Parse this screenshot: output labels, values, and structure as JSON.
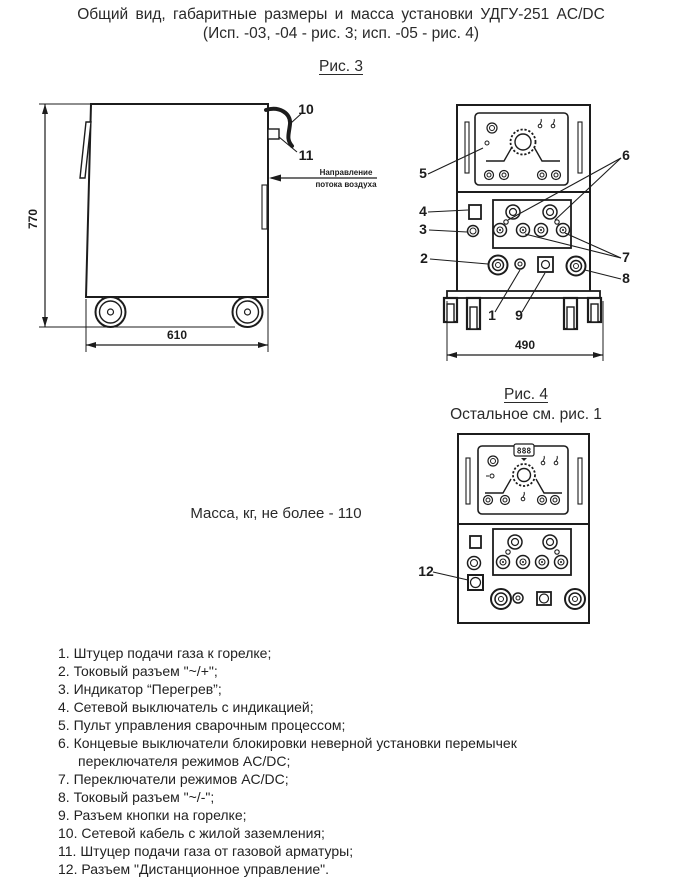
{
  "title": {
    "line1": "Общий вид, габаритные размеры и масса установки УДГУ-251 AC/DC",
    "line2": "(Исп. -03, -04 - рис. 3; исп. -05 - рис. 4)"
  },
  "fig3": {
    "caption": "Рис. 3",
    "side_view": {
      "dim_height": "770",
      "dim_width": "610",
      "callout_10": "10",
      "callout_11": "11",
      "airflow_line1": "Направление",
      "airflow_line2": "потока воздуха"
    },
    "front_view": {
      "dim_width": "490",
      "callout_1": "1",
      "callout_2": "2",
      "callout_3": "3",
      "callout_4": "4",
      "callout_5": "5",
      "callout_6": "6",
      "callout_7": "7",
      "callout_8": "8",
      "callout_9": "9"
    }
  },
  "fig4": {
    "caption": "Рис. 4",
    "note": "Остальное см. рис. 1",
    "display_value": "888",
    "callout_12": "12"
  },
  "mass_note": "Масса, кг, не более - 110",
  "legend": {
    "items": [
      "1. Штуцер подачи газа к горелке;",
      "2. Токовый разъем \"~/+\";",
      "3. Индикатор “Перегрев”;",
      "4. Сетевой выключатель с индикацией;",
      "5. Пульт управления сварочным процессом;",
      "6. Концевые выключатели блокировки неверной установки перемычек переключателя режимов AC/DC;",
      "7. Переключатели режимов AC/DC;",
      "8. Токовый разъем \"~/-\";",
      "9. Разъем кнопки на горелке;",
      "10. Сетевой кабель с жилой заземления;",
      "11. Штуцер подачи газа от газовой арматуры;",
      "12. Разъем \"Дистанционное управление\"."
    ]
  }
}
